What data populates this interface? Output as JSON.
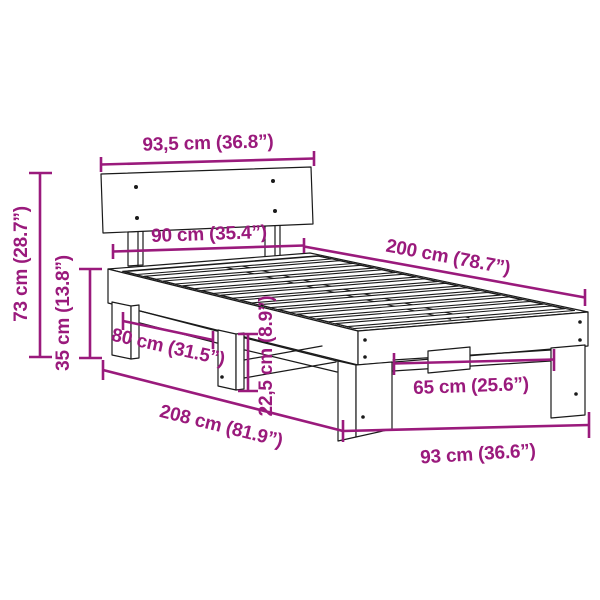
{
  "diagram": {
    "subject": "Bed frame with headboard and slatted base — technical dimension drawing",
    "accent_color": "#9a1a7c",
    "line_color": "#1a1a1a",
    "background_color": "#ffffff",
    "dimensions": {
      "headboard_width": {
        "label": "93,5 cm (36.8”)",
        "value_cm": 93.5,
        "value_in": 36.8
      },
      "total_height": {
        "label": "73 cm (28.7”)",
        "value_cm": 73,
        "value_in": 28.7
      },
      "frame_height": {
        "label": "35 cm (13.8”)",
        "value_cm": 35,
        "value_in": 13.8
      },
      "mattress_width": {
        "label": "90 cm (35.4”)",
        "value_cm": 90,
        "value_in": 35.4
      },
      "mattress_length": {
        "label": "200 cm (78.7”)",
        "value_cm": 200,
        "value_in": 78.7
      },
      "side_leg_spacing": {
        "label": "80 cm (31.5”)",
        "value_cm": 80,
        "value_in": 31.5
      },
      "under_bed_clearance": {
        "label": "22,5 cm (8.9”)",
        "value_cm": 22.5,
        "value_in": 8.9
      },
      "total_length": {
        "label": "208 cm (81.9”)",
        "value_cm": 208,
        "value_in": 81.9
      },
      "foot_leg_spacing": {
        "label": "65 cm (25.6”)",
        "value_cm": 65,
        "value_in": 25.6
      },
      "total_width": {
        "label": "93 cm (36.6”)",
        "value_cm": 93,
        "value_in": 36.6
      }
    }
  }
}
